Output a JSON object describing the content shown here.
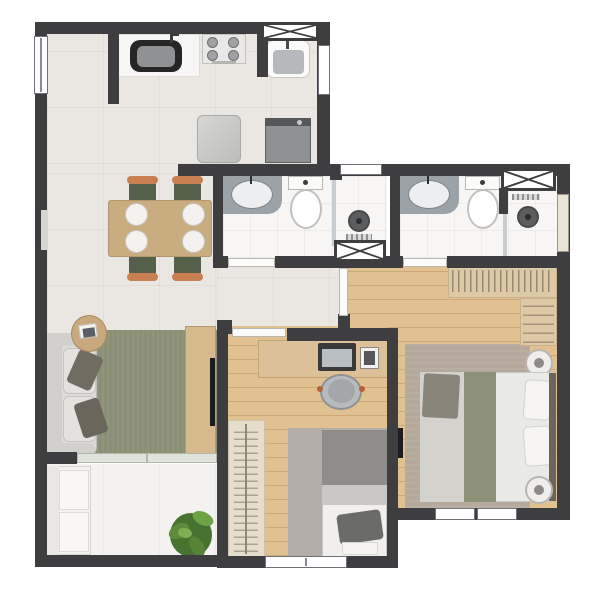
{
  "scene": {
    "type": "apartment-floor-plan",
    "view": "top-down",
    "rooms": [
      {
        "name": "kitchen",
        "furniture": [
          "counter-with-sink",
          "stove-4-burners",
          "refrigerator"
        ]
      },
      {
        "name": "service-area",
        "furniture": [
          "laundry-tank",
          "washing-machine",
          "shaft"
        ]
      },
      {
        "name": "dining-area",
        "furniture": [
          "dining-table",
          "chair-x4",
          "plate-x4"
        ]
      },
      {
        "name": "living-room",
        "furniture": [
          "sofa",
          "side-table",
          "olive-rug",
          "tv-console",
          "tv"
        ]
      },
      {
        "name": "corridor",
        "furniture": []
      },
      {
        "name": "bathroom-1",
        "furniture": [
          "vanity-counter-sink",
          "toilet",
          "shower-drain",
          "shaft",
          "vent-window"
        ]
      },
      {
        "name": "bathroom-2",
        "furniture": [
          "vanity-counter-sink",
          "toilet",
          "shower-head",
          "shaft",
          "window"
        ]
      },
      {
        "name": "master-bedroom",
        "furniture": [
          "l-shaped-wardrobe",
          "double-bed",
          "nightstand-x2",
          "rug",
          "wall-tv"
        ]
      },
      {
        "name": "office-bedroom",
        "furniture": [
          "desk",
          "laptop",
          "photo-frame",
          "office-chair",
          "wardrobe",
          "single-bed",
          "gray-rug"
        ]
      },
      {
        "name": "balcony",
        "furniture": [
          "bench-seat",
          "plant",
          "sliding-glass-door"
        ]
      }
    ]
  },
  "palette": {
    "wall": "#3e3e41",
    "floor_tile": "#eae7e2",
    "floor_wood": "#e2c191",
    "floor_bath": "#f7f6f4",
    "floor_balcony": "#f3f2f0",
    "rug_olive": "#8a8f75",
    "rug_gray": "#b3aea7",
    "rug_taupe": "#b5a99c",
    "wood_furniture": "#c9ac80",
    "closet_tan": "#ddc9a5",
    "counter_gray": "#9ba3a9",
    "sofa_gray": "#dcdbd9",
    "cushion_dark": "#716c61",
    "chair_olive": "#55604a",
    "chair_orange": "#c97f50",
    "appliance_gray": "#cfcfcc",
    "washer_gray": "#8f9194",
    "sink_black": "#262626",
    "bed_white": "#e9e9e6",
    "blanket_olive": "#8c9177",
    "blanket_gray": "#8f8d89",
    "plant_green": "#47722f",
    "plant_green_light": "#6da344",
    "glass_green": "#dfe4da"
  }
}
